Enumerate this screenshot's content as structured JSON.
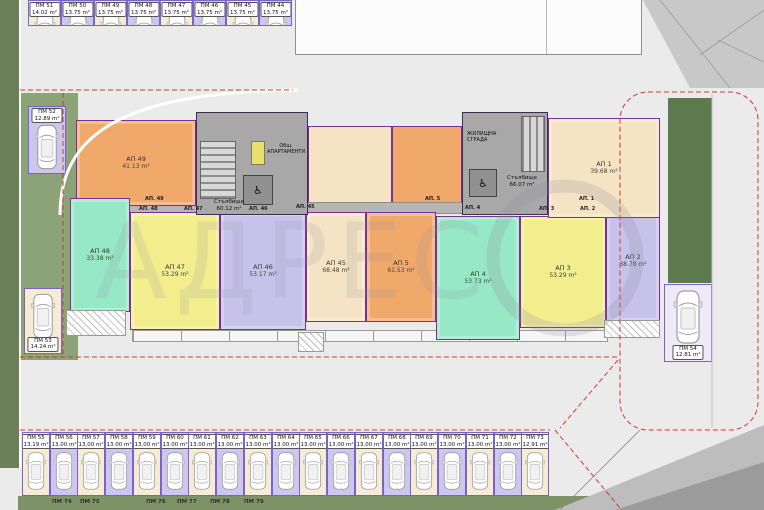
{
  "watermark": {
    "text": "АДРЕС"
  },
  "icons": {
    "wheelchair": "♿"
  },
  "palette": {
    "stall_cream": "#f6ecd4",
    "stall_purple": "#cdc6ee",
    "wall": "#7b2f93",
    "boundary_red": "#d23a2e",
    "green_dark": "#6a7f5a",
    "green_light": "#8ba377"
  },
  "building": {
    "name_label": "ЖИЛИЩНА СГРАДА",
    "common_area_label": "Общ. АПАРТАМЕНТИ",
    "stair_left": {
      "label": "Стълбище",
      "area": "60.12 m²"
    },
    "stair_right": {
      "label": "Стълбище",
      "area": "66.07 m²"
    },
    "apartments": [
      {
        "id": "АП 49",
        "area": "41.13 m²",
        "color": "#f0a96b"
      },
      {
        "id": "АП 48",
        "area": "33.38 m²",
        "color": "#97e8c6"
      },
      {
        "id": "АП 47",
        "area": "53.29 m²",
        "color": "#f2ee8e"
      },
      {
        "id": "АП 46",
        "area": "53.17 m²",
        "color": "#c7c2ea"
      },
      {
        "id": "АП 45",
        "area": "68.48 m²",
        "color": "#f4e4c3"
      },
      {
        "id": "АП 5",
        "area": "61.53 m²",
        "color": "#f0a96b"
      },
      {
        "id": "АП 4",
        "area": "53.73 m²",
        "color": "#97e8c6"
      },
      {
        "id": "АП 3",
        "area": "53.29 m²",
        "color": "#f2ee8e"
      },
      {
        "id": "АП 2",
        "area": "38.78 m²",
        "color": "#c7c2ea"
      },
      {
        "id": "АП 1",
        "area": "39.68 m²",
        "color": "#f4e4c3"
      }
    ],
    "terrace_labels": [
      "АП. 49",
      "АП. 48",
      "АП. 47",
      "АП. 46",
      "АП. 45",
      "АП. 5",
      "АП. 4",
      "АП. 3",
      "АП. 2",
      "АП. 1"
    ]
  },
  "parking": {
    "top_row": [
      {
        "id": "ПМ 51",
        "area": "14.02 m²"
      },
      {
        "id": "ПМ 50",
        "area": "13.75 m²"
      },
      {
        "id": "ПМ 49",
        "area": "13.75 m²"
      },
      {
        "id": "ПМ 48",
        "area": "13.75 m²"
      },
      {
        "id": "ПМ 47",
        "area": "13.75 m²"
      },
      {
        "id": "ПМ 46",
        "area": "13.75 m²"
      },
      {
        "id": "ПМ 45",
        "area": "13.75 m²"
      },
      {
        "id": "ПМ 44",
        "area": "13.75 m²"
      }
    ],
    "left_column": [
      {
        "id": "ПМ 52",
        "area": "12.89 m²"
      },
      {
        "id": "ПМ 53",
        "area": "14.24 m²"
      }
    ],
    "right_column": [
      {
        "id": "ПМ 54",
        "area": "12.81 m²"
      }
    ],
    "bottom_row": [
      {
        "id": "ПМ 55",
        "area": "13.19 m²"
      },
      {
        "id": "ПМ 56",
        "area": "13.00 m²"
      },
      {
        "id": "ПМ 57",
        "area": "13.00 m²"
      },
      {
        "id": "ПМ 58",
        "area": "13.00 m²"
      },
      {
        "id": "ПМ 59",
        "area": "13.00 m²"
      },
      {
        "id": "ПМ 60",
        "area": "13.00 m²"
      },
      {
        "id": "ПМ 61",
        "area": "13.00 m²"
      },
      {
        "id": "ПМ 62",
        "area": "13.00 m²"
      },
      {
        "id": "ПМ 63",
        "area": "13.00 m²"
      },
      {
        "id": "ПМ 64",
        "area": "13.00 m²"
      },
      {
        "id": "ПМ 65",
        "area": "13.00 m²"
      },
      {
        "id": "ПМ 66",
        "area": "13.00 m²"
      },
      {
        "id": "ПМ 67",
        "area": "13.00 m²"
      },
      {
        "id": "ПМ 68",
        "area": "13.00 m²"
      },
      {
        "id": "ПМ 69",
        "area": "13.00 m²"
      },
      {
        "id": "ПМ 70",
        "area": "13.00 m²"
      },
      {
        "id": "ПМ 71",
        "area": "13.00 m²"
      },
      {
        "id": "ПМ 72",
        "area": "13.00 m²"
      },
      {
        "id": "ПМ 73",
        "area": "12.91 m²"
      }
    ],
    "next_row_labels": [
      "ПМ 74",
      "ПМ 75",
      "ПМ 76",
      "ПМ 77",
      "ПМ 78",
      "ПМ 79"
    ]
  }
}
